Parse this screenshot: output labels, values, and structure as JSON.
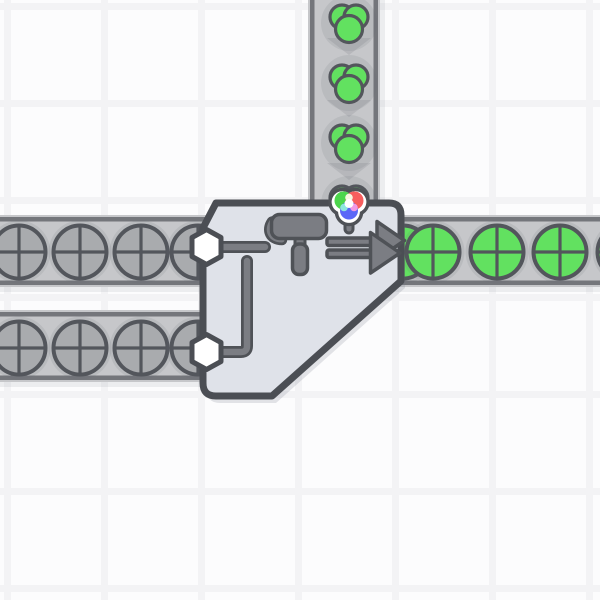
{
  "scene_type": "factory-game-canvas",
  "colors": {
    "bg": "#fcfcfd",
    "grid_line": "#f3f3f5",
    "belt_fill": "#c6c7ca",
    "belt_border": "#74767b",
    "belt_chevron": "#b6b7bb",
    "belt_shadow": "rgba(125,130,140,0.12)",
    "item_shadow": "rgba(100,105,118,0.13)",
    "outline_dark": "#53565c",
    "icon_gray": "#7b7d83",
    "icon_outline": "#4f5257",
    "machine_fill": "#dfe2e9",
    "machine_border": "#4b4e54",
    "machine_shadow": "rgba(120,125,138,0.20)",
    "shape_gray": "#a9abae",
    "shape_green": "#62e160",
    "hexagon_fill": "#ffffff",
    "wheel_red": "#f75e5e",
    "wheel_green": "#4cd54c",
    "wheel_blue": "#5b67f7",
    "wheel_cyan": "#8ee6e0",
    "wheel_magenta": "#f19ae4",
    "wheel_pale": "#f6f6e0",
    "wheel_white": "#ffffff"
  },
  "scene": {
    "grid": {
      "pitch": 97,
      "offset_x": 4,
      "offset_y": 3,
      "line_width": 7
    },
    "belts": [
      {
        "id": "belt-color-input",
        "orientation": "vertical",
        "x": 308,
        "y": 0,
        "length": 208,
        "thickness": 72,
        "direction": "down"
      },
      {
        "id": "belt-shape-row-top",
        "orientation": "horizontal",
        "x": 0,
        "y": 215,
        "length": 600,
        "thickness": 72,
        "direction": "right"
      },
      {
        "id": "belt-shape-row-bottom",
        "orientation": "horizontal",
        "x": 0,
        "y": 310,
        "length": 265,
        "thickness": 72,
        "direction": "right"
      }
    ],
    "chevrons": [
      [
        349,
        38
      ],
      [
        349,
        100
      ],
      [
        349,
        163
      ]
    ],
    "items": {
      "color_green": [
        [
          349,
          23
        ],
        [
          349,
          83
        ],
        [
          349,
          143
        ],
        [
          349,
          204
        ]
      ],
      "circle_uncolored": [
        [
          19,
          252
        ],
        [
          80,
          252
        ],
        [
          141,
          252
        ],
        [
          198,
          252
        ],
        [
          19,
          348
        ],
        [
          80,
          348
        ],
        [
          141,
          348
        ],
        [
          198,
          348
        ]
      ],
      "circle_green": [
        [
          403,
          252
        ],
        [
          433,
          252
        ],
        [
          497,
          252
        ],
        [
          560,
          252
        ],
        [
          624,
          252
        ]
      ]
    },
    "machine": {
      "type": "painter-double",
      "x": 203,
      "y": 203,
      "width": 198,
      "height": 193
    }
  }
}
